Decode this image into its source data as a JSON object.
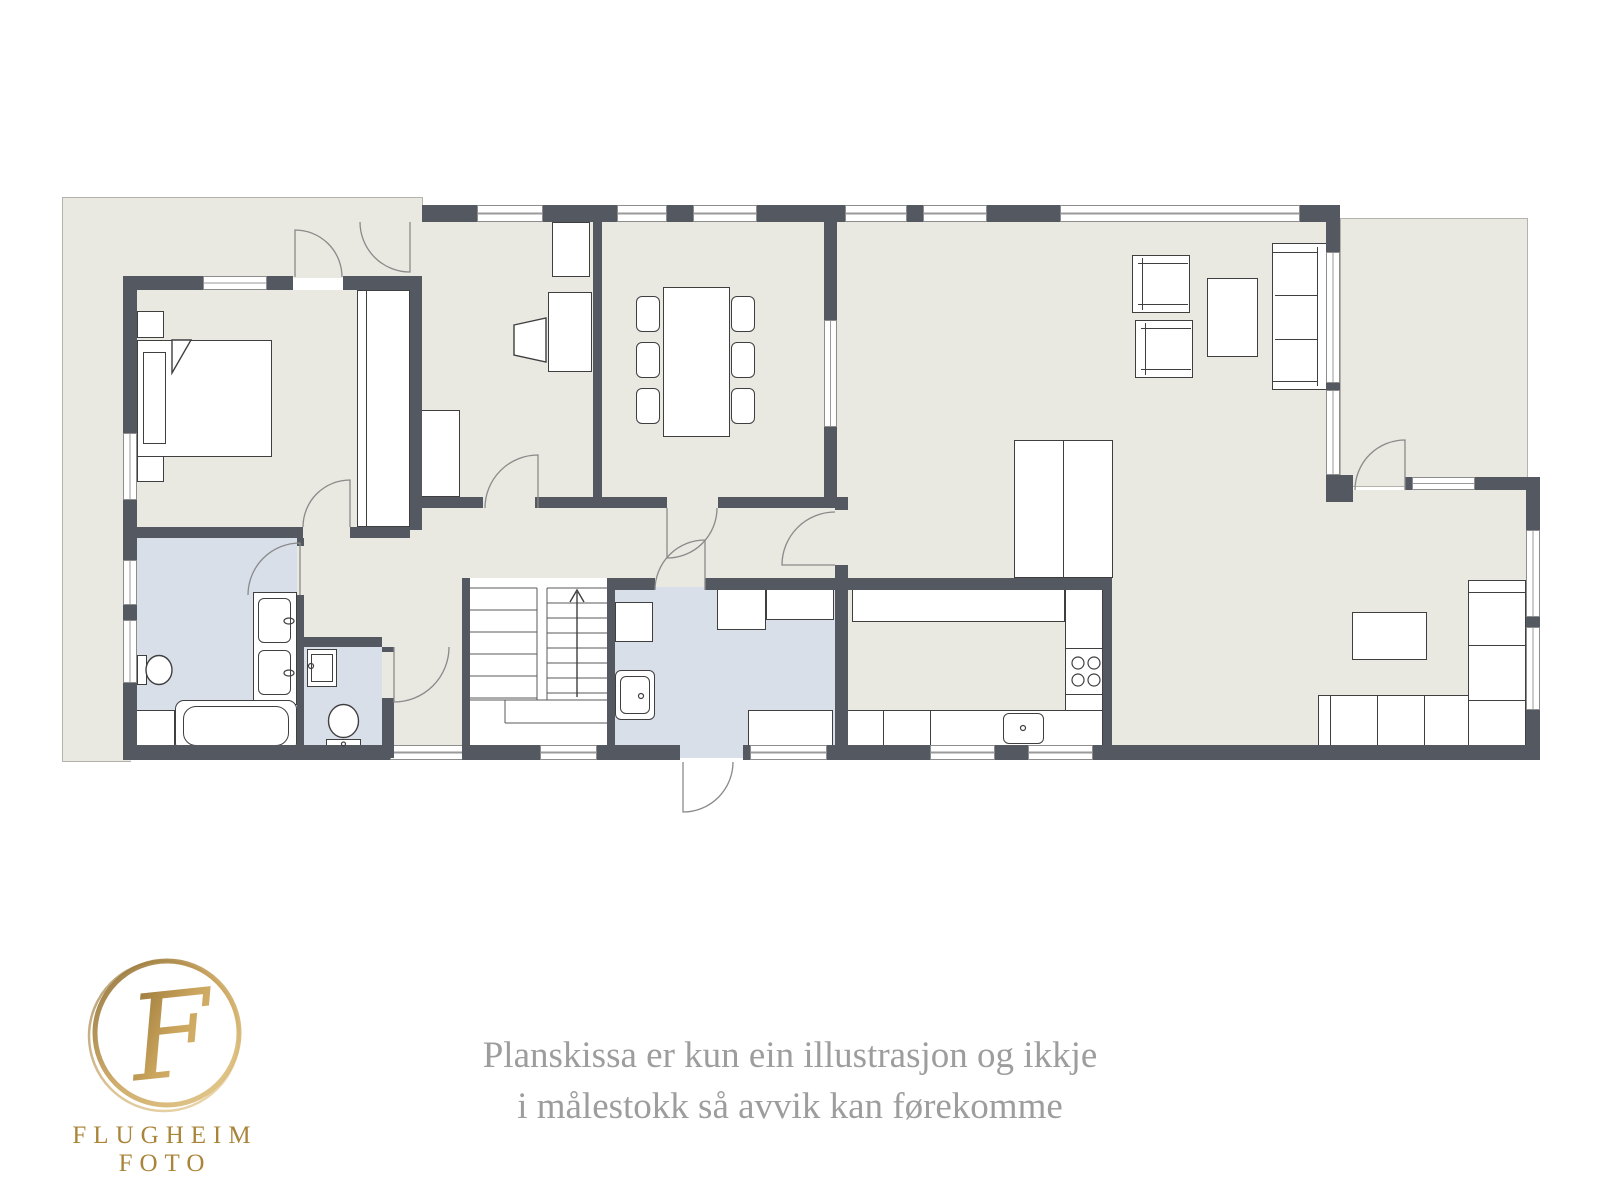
{
  "caption": {
    "line1": "Planskissa er kun ein illustrasjon og ikkje",
    "line2": "i målestokk så avvik kan førekomme"
  },
  "logo": {
    "monogram": "F",
    "wordmark": "FLUGHEIM FOTO"
  },
  "colors": {
    "wall": "#545861",
    "floor": "#e9e8e1",
    "wet_room": "#d9dfe9",
    "terrace_outline": "#b3b3ab",
    "furniture_outline": "#3f3f3f",
    "door_arc": "#8a8a8a",
    "logo_gold": "#b78b3d",
    "caption_text": "#9d9d9d"
  }
}
